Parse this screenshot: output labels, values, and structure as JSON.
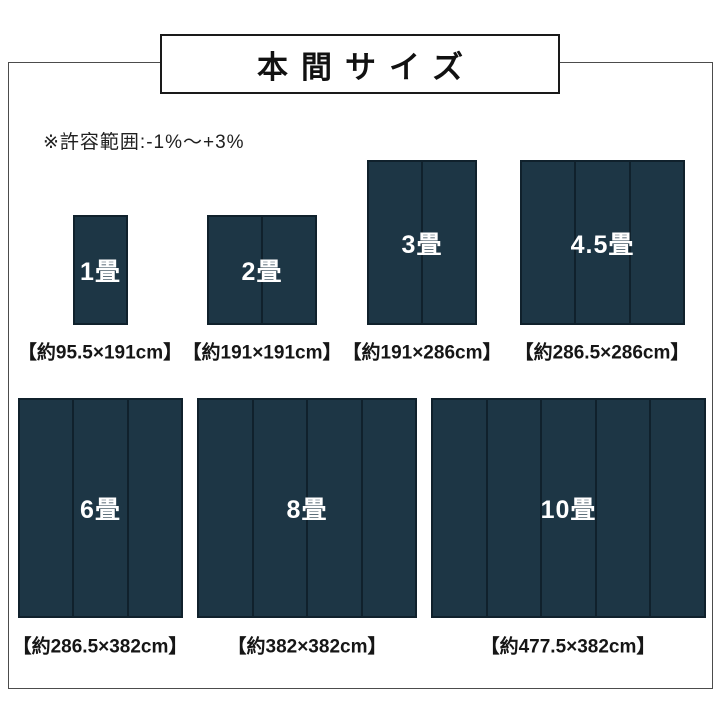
{
  "title": "本間サイズ",
  "note": "※許容範囲:-1%〜+3%",
  "colors": {
    "mat_fill": "#1d3645",
    "mat_line": "#10212c",
    "frame_border": "#4c4c4c",
    "title_border": "#1a1a1a",
    "text_on_mat": "#ffffff"
  },
  "mats": [
    {
      "name": "1畳",
      "size_label": "【約95.5×191cm】",
      "width_cm": 95.5,
      "height_cm": 191,
      "panels": 1
    },
    {
      "name": "2畳",
      "size_label": "【約191×191cm】",
      "width_cm": 191,
      "height_cm": 191,
      "panels": 2
    },
    {
      "name": "3畳",
      "size_label": "【約191×286cm】",
      "width_cm": 191,
      "height_cm": 286,
      "panels": 2
    },
    {
      "name": "4.5畳",
      "size_label": "【約286.5×286cm】",
      "width_cm": 286.5,
      "height_cm": 286,
      "panels": 3
    },
    {
      "name": "6畳",
      "size_label": "【約286.5×382cm】",
      "width_cm": 286.5,
      "height_cm": 382,
      "panels": 3
    },
    {
      "name": "8畳",
      "size_label": "【約382×382cm】",
      "width_cm": 382,
      "height_cm": 382,
      "panels": 4
    },
    {
      "name": "10畳",
      "size_label": "【約477.5×382cm】",
      "width_cm": 477.5,
      "height_cm": 382,
      "panels": 5
    }
  ]
}
